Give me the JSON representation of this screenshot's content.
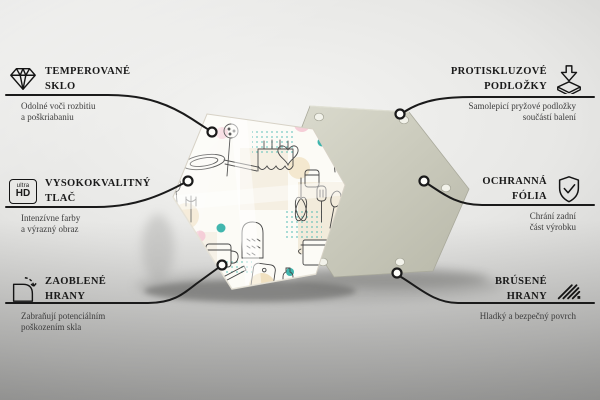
{
  "features": {
    "left": [
      {
        "icon": "diamond-icon",
        "title1": "TEMPEROVANÉ",
        "title2": "SKLO",
        "desc1": "Odolné voči rozbitiu",
        "desc2": "a poškriabaniu"
      },
      {
        "icon": "ultra-hd-icon",
        "icon_text_small": "ultra",
        "icon_text_big": "HD",
        "title1": "VYSOKOKVALITNÝ",
        "title2": "TLAČ",
        "desc1": "Intenzívne farby",
        "desc2": "a výrazný obraz"
      },
      {
        "icon": "rounded-corner-icon",
        "title1": "ZAOBLENÉ",
        "title2": "HRANY",
        "desc1": "Zabraňují potenciálním",
        "desc2": "poškozením skla"
      }
    ],
    "right": [
      {
        "icon": "anti-slip-pad-icon",
        "title1": "PROTISKLUZOVÉ",
        "title2": "PODLOŽKY",
        "desc1": "Samolepicí pryžové podložky",
        "desc2": "součástí balení"
      },
      {
        "icon": "shield-check-icon",
        "title1": "OCHRANNÁ",
        "title2": "FÓLIA",
        "desc1": "Chrání zadní",
        "desc2": "část výrobku"
      },
      {
        "icon": "polished-edge-icon",
        "title1": "BRÚSENÉ",
        "title2": "HRANY",
        "desc1": "Hladký a bezpečný povrch",
        "desc2": ""
      }
    ]
  },
  "colors": {
    "line": "#1a1a1a",
    "teal_accent": "#3fb5ad",
    "pastel_pink": "#f4c7d3",
    "pastel_beige": "#f1e3c6",
    "board_gray": "#cfcfc2"
  }
}
